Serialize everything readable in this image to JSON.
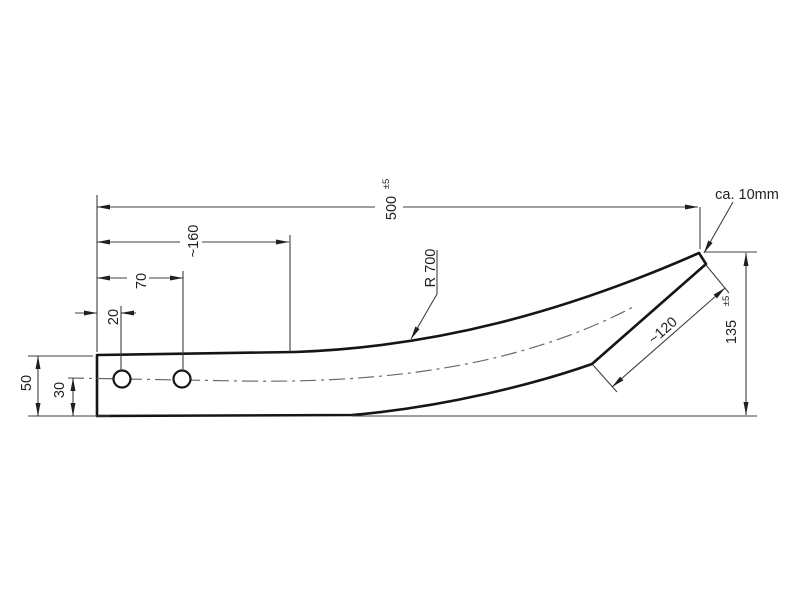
{
  "drawing": {
    "background": "#ffffff",
    "colors": {
      "outline": "#151515",
      "thin_line": "#3f3f3f",
      "center_line": "#6a6a6a",
      "text": "#1f1f1f"
    },
    "dimensions": {
      "overall_length": {
        "value": "500",
        "tolerance": "±5"
      },
      "hole_span_approx": {
        "value": "~160"
      },
      "second_hole_offset": {
        "value": "70"
      },
      "first_hole_offset": {
        "value": "20"
      },
      "bar_height": {
        "value": "50"
      },
      "hole_center_height": {
        "value": "30"
      },
      "tip_height": {
        "value": "135",
        "tolerance": "±5"
      },
      "tip_edge_length_approx": {
        "value": "~120"
      },
      "bend_radius": {
        "value": "R 700"
      },
      "tip_note": {
        "value": "ca. 10mm"
      }
    }
  }
}
